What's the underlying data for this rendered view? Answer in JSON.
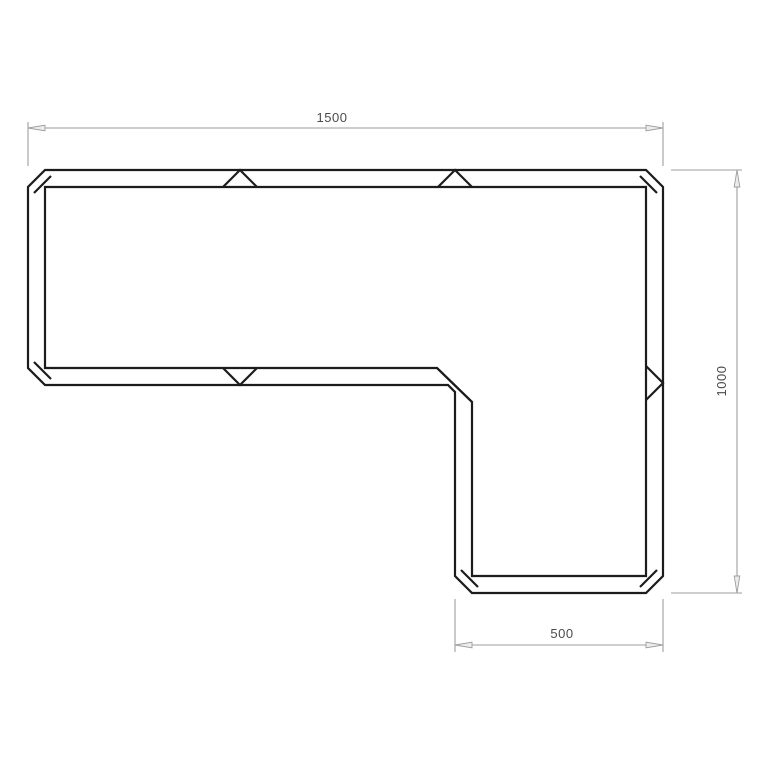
{
  "drawing": {
    "dimensions": {
      "top": {
        "label": "1500"
      },
      "right": {
        "label": "1000"
      },
      "bottom": {
        "label": "500"
      }
    },
    "colors": {
      "outline": "#1c1c1c",
      "dimension_line": "#9e9e9e",
      "dimension_text": "#4b4b4b",
      "arrow_fill": "#ececec",
      "background": "#ffffff"
    }
  }
}
